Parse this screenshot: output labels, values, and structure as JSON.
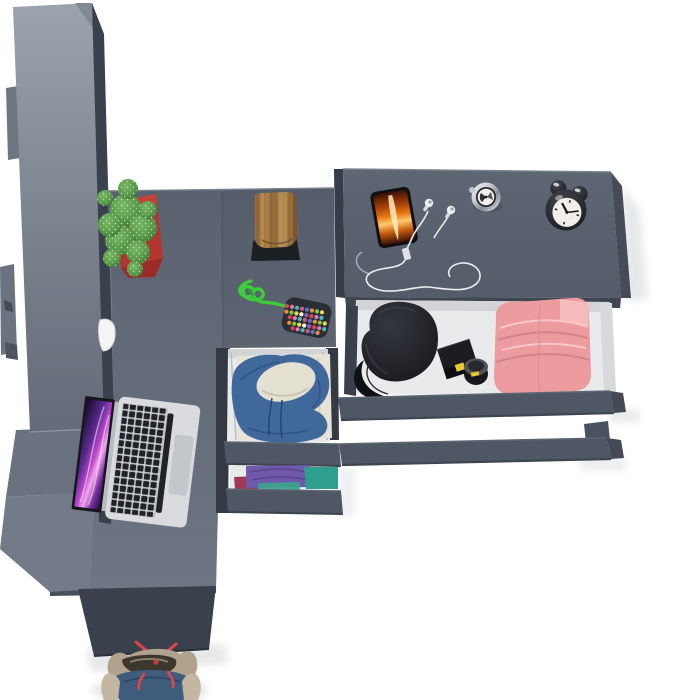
{
  "meta": {
    "title": "Top-down 3D render of a gray furniture set with wardrobe, desk and dresser",
    "canvas": {
      "width": 680,
      "height": 700
    }
  },
  "colors": {
    "background": "#ffffff",
    "surface_top": "#5a6270",
    "surface_bottom": "#6e7683",
    "dresser_top": "#5e6673",
    "dresser_bottom": "#545c69",
    "wardrobe_light": "#9ba3ae",
    "wardrobe_dark": "#636b78",
    "side_dark": "#3a414c",
    "drawer_front": "#4f5765",
    "drawer_interior": "#e9eaeb",
    "pot_red": "#b23530",
    "plant_green": "#57984a",
    "plant_dark": "#2f6b2e",
    "wood_mid": "#9a7140",
    "stand_black": "#1c1f24",
    "cord_green": "#3ecb3c",
    "pouch_dark": "#2b2e34",
    "laptop_silver": "#d9dbde",
    "key_dark": "#202226",
    "screen_magenta": "#c14ad0",
    "fire_orange": "#e87613",
    "cable_white": "#f2f3f5",
    "chrome": "#c3c7cd",
    "clock_black": "#16171b",
    "clock_face": "#f1efe8",
    "hat_black": "#17181c",
    "label_yellow": "#e6c930",
    "pink_clothes": "#ec9b9e",
    "hoodie_blue": "#41689a",
    "cream": "#e7e3d6",
    "purple_clothes": "#7059ab",
    "teal_clothes": "#2e9e8f",
    "crimson_clothes": "#a03a50",
    "shoe_tan": "#b0a28c",
    "shoe_blue": "#3f5c7d",
    "lace_red": "#e0444c"
  },
  "items": {
    "wardrobe": {
      "label": "Tall wardrobe cabinet seen from above"
    },
    "desk": {
      "label": "L-shaped desk surface"
    },
    "dresser": {
      "label": "Dresser with open drawer"
    },
    "middle_drawers": {
      "label": "Under-desk drawer unit with clothes"
    },
    "cactus": {
      "label": "Spiky cactus in red square pot"
    },
    "stump": {
      "label": "Decorative wooden stump on black stand"
    },
    "keychain": {
      "label": "Green paracord knot with beaded pouch",
      "bead_colors": [
        "#d94b4b",
        "#f0d84f",
        "#4b79d9",
        "#e077c0",
        "#ffffff",
        "#ef8f3f",
        "#45c0b0",
        "#9b59b6",
        "#7ec850",
        "#e05575"
      ]
    },
    "laptop": {
      "label": "Open silver laptop with purple wallpaper"
    },
    "white_object": {
      "label": "Small white object on desk"
    },
    "phone": {
      "label": "Smartphone with fiery orange wallpaper"
    },
    "earphones": {
      "label": "White wired earphones with tangled cable"
    },
    "compass": {
      "label": "Silver pocket compass"
    },
    "alarm_clock": {
      "label": "Black twin-bell alarm clock"
    },
    "cap": {
      "label": "Black cap inside open drawer"
    },
    "black_case": {
      "label": "Black case with yellow label"
    },
    "round_container": {
      "label": "Round black container with yellow mark"
    },
    "pink_clothes": {
      "label": "Folded pink trousers"
    },
    "hoodie": {
      "label": "Blue hoodie over cream clothes in drawer"
    },
    "folded_clothes": {
      "label": "Folded purple, teal and crimson clothes"
    },
    "sneaker": {
      "label": "Blue-and-tan sneaker with red laces"
    }
  }
}
